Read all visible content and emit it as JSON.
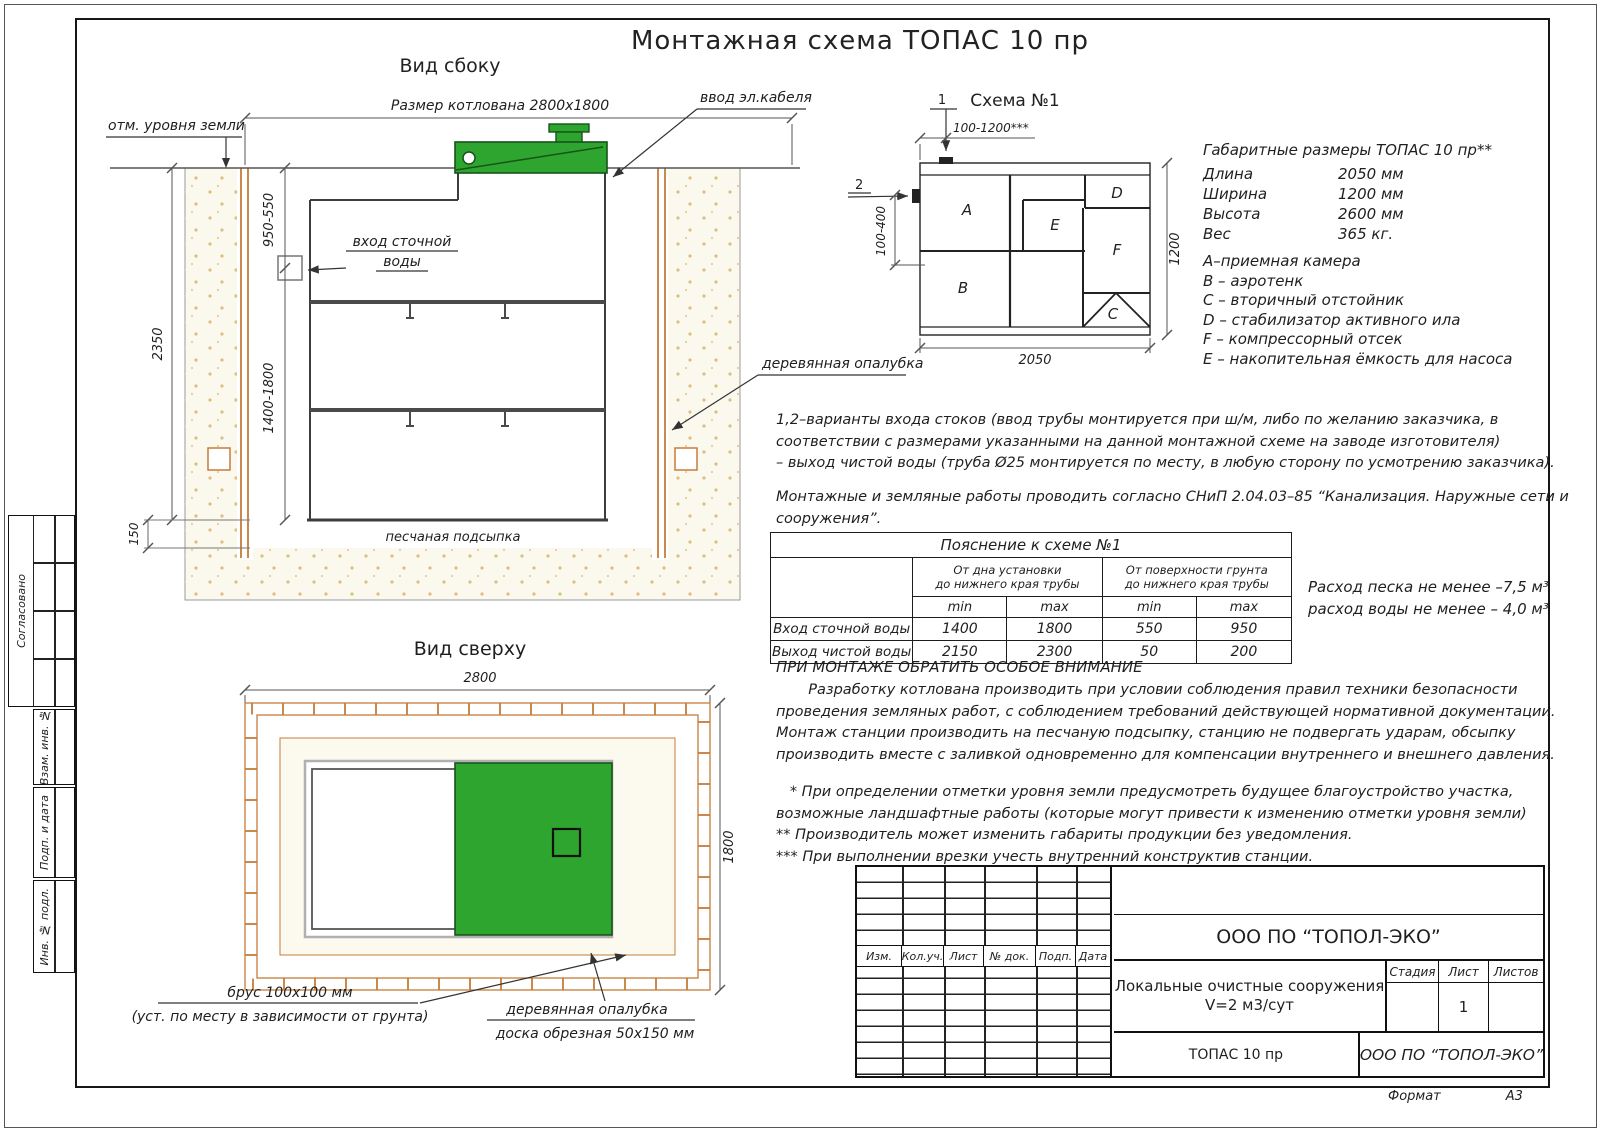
{
  "title": "Монтажная схема ТОПАС 10 пр",
  "side_view": {
    "title": "Вид сбоку",
    "pit_dim": "Размер котлована 2800х1800",
    "ground": "отм. уровня земли",
    "cable": "ввод эл.кабеля",
    "inlet1": "вход сточной",
    "inlet2": "воды",
    "formwork": "деревянная опалубка",
    "sand_bed": "песчаная подсыпка",
    "d2350": "2350",
    "d950": "950-550",
    "d1400": "1400-1800",
    "d150": "150"
  },
  "top_view": {
    "title": "Вид сверху",
    "d2800": "2800",
    "d1800": "1800",
    "beam1": "брус 100х100 мм",
    "beam2": "(уст. по месту в зависимости от грунта)",
    "fw1": "деревянная опалубка",
    "fw2": "доска обрезная 50х150 мм"
  },
  "schema": {
    "title": "Схема №1",
    "m1": "1",
    "m2": "2",
    "dtop": "100-1200***",
    "dleft": "100-400",
    "dright": "1200",
    "dbottom": "2050",
    "a": "A",
    "b": "B",
    "c": "C",
    "d": "D",
    "e": "E",
    "f": "F"
  },
  "specs": {
    "title": "Габаритные размеры ТОПАС 10 пр**",
    "rows": [
      {
        "label": "Длина",
        "value": "2050 мм"
      },
      {
        "label": "Ширина",
        "value": "1200 мм"
      },
      {
        "label": "Высота",
        "value": "2600 мм"
      },
      {
        "label": "Вес",
        "value": "365 кг."
      }
    ]
  },
  "legend": [
    "А–приемная  камера",
    "В – аэротенк",
    "С – вторичный отстойник",
    "D – стабилизатор активного  ила",
    "F  – компрессорный отсек",
    "Е – накопительная ёмкость для насоса"
  ],
  "notes": {
    "var1": "1,2–варианты входа  стоков (ввод трубы монтируется при ш/м, либо по желанию заказчика, в",
    "var2": "соответствии с размерами указанными на данной монтажной схеме на заводе изготовителя)",
    "var3": "– выход чистой воды (труба Ø25 монтируется по месту, в любую сторону по усмотрению заказчика).",
    "snip1": "Монтажные и земляные работы проводить согласно СНиП 2.04.03–85 “Канализация. Наружные сети и",
    "snip2": "сооружения”.",
    "cons1": "Расход песка не менее –7,5 м³",
    "cons2": "расход воды не менее – 4,0 м³",
    "att_title": "ПРИ МОНТАЖЕ ОБРАТИТЬ ОСОБОЕ ВНИМАНИЕ",
    "att1": "       Разработку котлована производить при условии соблюдения правил техники безопасности",
    "att2": "проведения земляных работ, с соблюдением требований действующей нормативной документации.",
    "att3": "Монтаж станции производить на песчаную подсыпку, станцию не подвергать ударам, обсыпку",
    "att4": "производить вместе с заливкой одновременно для компенсации внутреннего и внешнего давления.",
    "fn1": "   * При определении отметки уровня земли предусмотреть будущее благоустройство участка,",
    "fn2": "возможные ландшафтные работы (которые могут привести к изменению отметки уровня земли)",
    "fn3": "** Производитель может изменить габариты продукции без уведомления.",
    "fn4": "*** При выполнении врезки учесть внутренний конструктив станции."
  },
  "expl_table": {
    "title": "Пояснение к схеме №1",
    "g1": "От дна установки\nдо нижнего края трубы",
    "g2": "От поверхности грунта\nдо нижнего края трубы",
    "mm": [
      "min",
      "max",
      "min",
      "max"
    ],
    "rows": [
      {
        "name": "Вход сточной воды",
        "v": [
          "1400",
          "1800",
          "550",
          "950"
        ]
      },
      {
        "name": "Выход чистой воды",
        "v": [
          "2150",
          "2300",
          "50",
          "200"
        ]
      }
    ]
  },
  "title_block": {
    "header_cols": [
      "Изм.",
      "Кол.уч.",
      "Лист",
      "№ док.",
      "Подп.",
      "Дата"
    ],
    "company": "ООО ПО “ТОПОЛ-ЭКО”",
    "project_line1": "Локальные очистные сооружения",
    "project_line2": "V=2 м3/сут",
    "stage_label": "Стадия",
    "sheet_label": "Лист",
    "sheets_label": "Листов",
    "sheet_value": "1",
    "product": "ТОПАС 10 пр",
    "company2": "ООО ПО “ТОПОЛ-ЭКО”"
  },
  "stamp": {
    "approved": "Согласовано",
    "cell1": "Взам. инв. №",
    "cell2": "Подп. и дата",
    "cell3": "Инв. № подл."
  },
  "format": {
    "label": "Формат",
    "value": "А3"
  },
  "colors": {
    "green": "#2EA52E",
    "formwork_orange": "#c77c3a",
    "sand_dot": "#dcbe7e"
  }
}
